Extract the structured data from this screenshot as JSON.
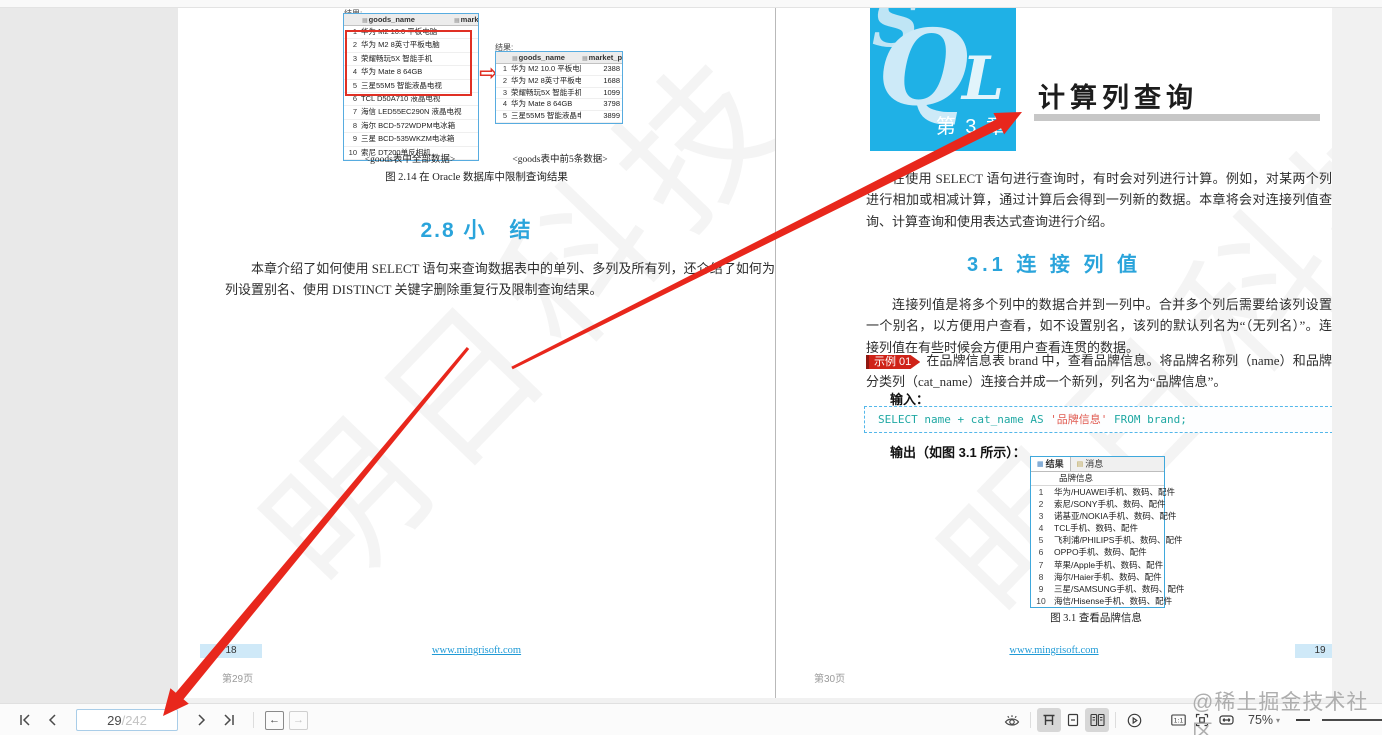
{
  "viewer": {
    "top_watermark": "@稀土掘金技术社区",
    "toolbar": {
      "page_current": "29",
      "page_total": "/242",
      "zoom_level": "75%"
    }
  },
  "icons": {
    "transform_arrow": "⇨",
    "grid_tab": "▦",
    "message_tab": "▤",
    "column_glyph": "▦",
    "caret_down": "▾",
    "back_arrow": "←",
    "forward_arrow": "→",
    "actual_size_label": "1:1"
  },
  "left_page": {
    "result_label_full": "结果:",
    "result_label_top5": "结果:",
    "table_full": {
      "columns": [
        "goods_name",
        "market_price"
      ],
      "rows": [
        {
          "n": "1",
          "name": "华为 M2 10.0 平板电脑"
        },
        {
          "n": "2",
          "name": "华为 M2 8英寸平板电脑"
        },
        {
          "n": "3",
          "name": "荣耀畅玩5X 智能手机"
        },
        {
          "n": "4",
          "name": "华为 Mate 8 64GB"
        },
        {
          "n": "5",
          "name": "三星55M5 智能液晶电视"
        },
        {
          "n": "6",
          "name": "TCL D50A710 液晶电视"
        },
        {
          "n": "7",
          "name": "海信 LED55EC290N 液晶电视"
        },
        {
          "n": "8",
          "name": "海尔 BCD-572WDPM电冰箱"
        },
        {
          "n": "9",
          "name": "三星 BCD-535WKZM电冰箱"
        },
        {
          "n": "10",
          "name": "索尼 DT200单反相机"
        }
      ],
      "caption": "<goods表中全部数据>"
    },
    "table_top5": {
      "columns": [
        "goods_name",
        "market_price"
      ],
      "rows": [
        {
          "n": "1",
          "name": "华为 M2 10.0 平板电脑",
          "price": "2388"
        },
        {
          "n": "2",
          "name": "华为 M2 8英寸平板电脑",
          "price": "1688"
        },
        {
          "n": "3",
          "name": "荣耀畅玩5X 智能手机",
          "price": "1099"
        },
        {
          "n": "4",
          "name": "华为 Mate 8 64GB",
          "price": "3798"
        },
        {
          "n": "5",
          "name": "三星55M5 智能液晶电视",
          "price": "3899"
        }
      ],
      "caption": "<goods表中前5条数据>"
    },
    "figure_caption": "图 2.14  在 Oracle 数据库中限制查询结果",
    "section_heading": "2.8 小　结",
    "summary": "本章介绍了如何使用 SELECT 语句来查询数据表中的单列、多列及所有列，还介绍了如何为列设置别名、使用 DISTINCT 关键字删除重复行及限制查询结果。",
    "corner_page_number": "18",
    "footer_link": "www.mingrisoft.com",
    "footer_page_label": "第29页",
    "watermark": "明日科技"
  },
  "right_page": {
    "chapter_logo": {
      "s": "S",
      "q": "Q",
      "l": "L",
      "chapter": "第 3 章"
    },
    "chapter_title": "计算列查询",
    "intro": "在使用 SELECT 语句进行查询时，有时会对列进行计算。例如，对某两个列进行相加或相减计算，通过计算后会得到一列新的数据。本章将会对连接列值查询、计算查询和使用表达式查询进行介绍。",
    "section_heading": "3.1 连 接 列 值",
    "section_intro": "连接列值是将多个列中的数据合并到一列中。合并多个列后需要给该列设置一个别名，以方便用户查看，如不设置别名，该列的默认列名为“（无列名）”。连接列值在有些时候会方便用户查看连贯的数据。",
    "example": {
      "badge": "示例 01",
      "text": "在品牌信息表 brand 中，查看品牌信息。将品牌名称列（name）和品牌分类列（cat_name）连接合并成一个新列，列名为“品牌信息”。"
    },
    "input_label": "输入：",
    "code": {
      "keyword_part": "SELECT name + cat_name AS ",
      "string_part": "'品牌信息'",
      "tail_part": " FROM brand;"
    },
    "output_label": "输出（如图 3.1 所示）：",
    "result_grid": {
      "tab_result": "结果",
      "tab_message": "消息",
      "column_header": "品牌信息",
      "rows": [
        {
          "n": "1",
          "text": "华为/HUAWEI手机、数码、配件"
        },
        {
          "n": "2",
          "text": "索尼/SONY手机、数码、配件"
        },
        {
          "n": "3",
          "text": "诺基亚/NOKIA手机、数码、配件"
        },
        {
          "n": "4",
          "text": "TCL手机、数码、配件"
        },
        {
          "n": "5",
          "text": "飞利浦/PHILIPS手机、数码、配件"
        },
        {
          "n": "6",
          "text": "OPPO手机、数码、配件"
        },
        {
          "n": "7",
          "text": "苹果/Apple手机、数码、配件"
        },
        {
          "n": "8",
          "text": "海尔/Haier手机、数码、配件"
        },
        {
          "n": "9",
          "text": "三星/SAMSUNG手机、数码、配件"
        },
        {
          "n": "10",
          "text": "海信/Hisense手机、数码、配件"
        }
      ]
    },
    "figure_caption": "图 3.1  查看品牌信息",
    "corner_page_number": "19",
    "footer_link": "www.mingrisoft.com",
    "footer_page_label": "第30页",
    "watermark": "明日科技"
  }
}
